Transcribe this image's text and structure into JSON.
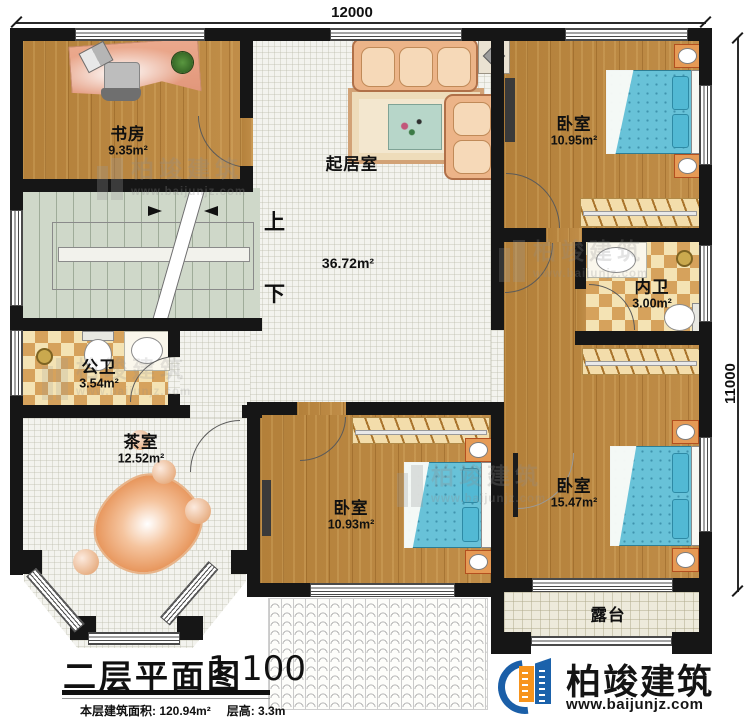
{
  "dimensions": {
    "top": "12000",
    "right": "11000"
  },
  "rooms": {
    "study": {
      "name": "书房",
      "area": "9.35m²"
    },
    "living": {
      "name": "起居室",
      "area": "36.72m²"
    },
    "bedroom_tr": {
      "name": "卧室",
      "area": "10.95m²"
    },
    "bath_inner": {
      "name": "内卫",
      "area": "3.00m²"
    },
    "bath_public": {
      "name": "公卫",
      "area": "3.54m²"
    },
    "tea": {
      "name": "茶室",
      "area": "12.52m²"
    },
    "bedroom_bm": {
      "name": "卧室",
      "area": "10.93m²"
    },
    "bedroom_br": {
      "name": "卧室",
      "area": "15.47m²"
    },
    "terrace": {
      "name": "露台"
    }
  },
  "stairs": {
    "up": "上",
    "down": "下"
  },
  "titleblock": {
    "title": "二层平面图",
    "scale": "1:100",
    "area_label": "本层建筑面积: 120.94m²",
    "height_label": "层高: 3.3m"
  },
  "brand": {
    "name": "柏竣建筑",
    "url": "www.baijunjz.com"
  },
  "watermark": {
    "name": "柏竣建筑",
    "url": "www.baijunjz.com"
  },
  "colors": {
    "wall": "#161616",
    "wood": "#b8853c",
    "bed_blue": "#68c2d8",
    "brand_orange": "#f7941d",
    "brand_blue": "#1b5fa8"
  }
}
